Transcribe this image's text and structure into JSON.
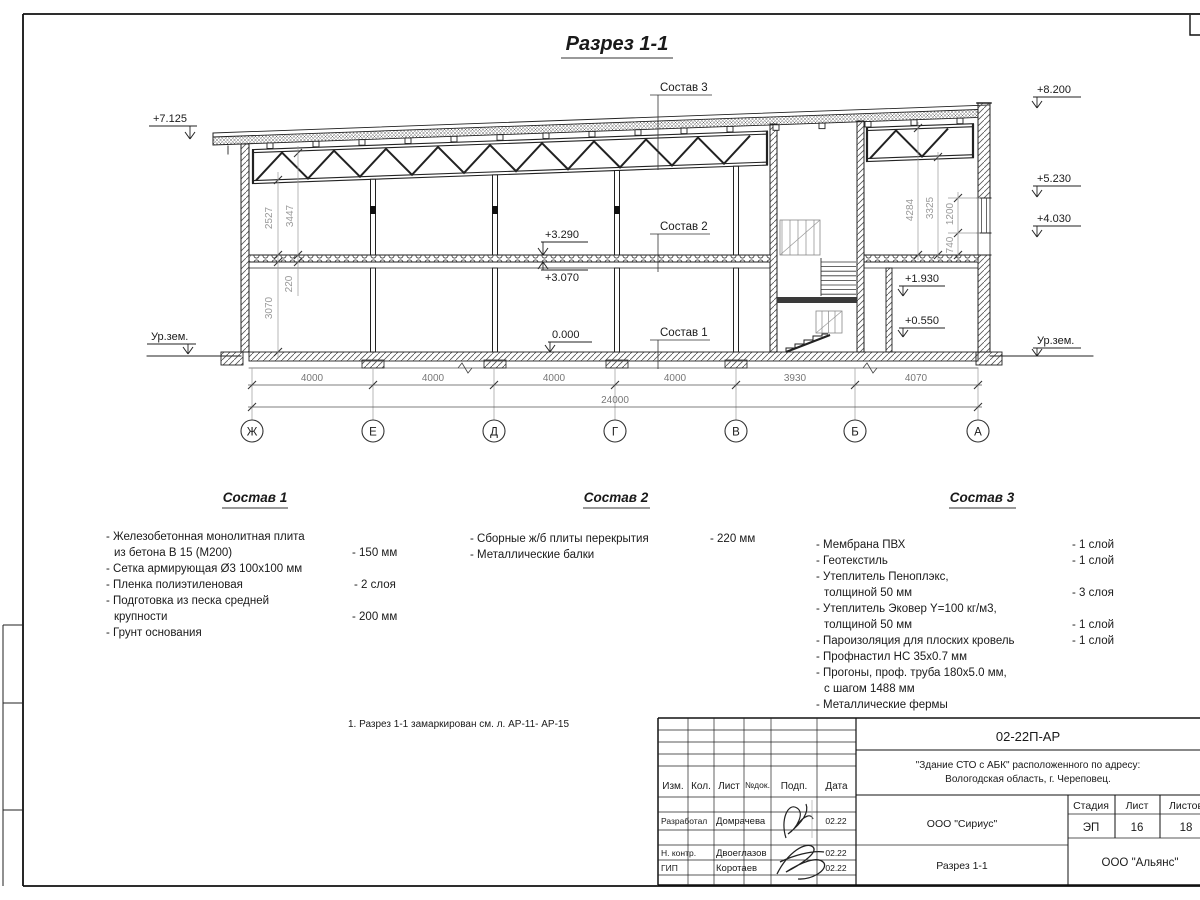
{
  "sheet": {
    "title": "Разрез 1-1",
    "note": "1. Разрез 1-1 замаркирован см. л. АР-11- АР-15"
  },
  "drawing": {
    "labels": {
      "sostav1": "Состав 1",
      "sostav2": "Состав 2",
      "sostav3": "Состав 3"
    },
    "elevations": {
      "left_top": "+7.125",
      "right_top": "+8.200",
      "right_mid1": "+5.230",
      "right_mid2": "+4.030",
      "slab_top": "+3.290",
      "slab_bottom": "+3.070",
      "floor_zero": "0.000",
      "landing": "+1.930",
      "entry": "+0.550",
      "ground_left": "Ур.зем.",
      "ground_right": "Ур.зем."
    },
    "vertical_dims": {
      "left_outer": "2527",
      "left_inner": "3447",
      "slab": "220",
      "first_floor": "3070",
      "right_outer": "4284",
      "right_inner": "3325",
      "window": "1200",
      "parapet": "740"
    },
    "horizontal_dims": [
      "4000",
      "4000",
      "4000",
      "4000",
      "3930",
      "4070"
    ],
    "total_dim": "24000",
    "axes": [
      "Ж",
      "Е",
      "Д",
      "Г",
      "В",
      "Б",
      "А"
    ]
  },
  "specs": {
    "s1": {
      "title": "Состав 1",
      "lines": [
        {
          "t": "- Железобетонная монолитная плита",
          "v": ""
        },
        {
          "t": "из бетона В 15 (М200)",
          "v": "- 150 мм"
        },
        {
          "t": "- Сетка армирующая Ø3 100х100 мм",
          "v": ""
        },
        {
          "t": "- Пленка полиэтиленовая",
          "v": "- 2 слоя"
        },
        {
          "t": "- Подготовка из песка средней",
          "v": ""
        },
        {
          "t": "крупности",
          "v": "- 200 мм"
        },
        {
          "t": "- Грунт основания",
          "v": ""
        }
      ]
    },
    "s2": {
      "title": "Состав 2",
      "lines": [
        {
          "t": "- Сборные ж/б плиты перекрытия",
          "v": "- 220 мм"
        },
        {
          "t": "- Металлические балки",
          "v": ""
        }
      ]
    },
    "s3": {
      "title": "Состав 3",
      "lines": [
        {
          "t": "- Мембрана ПВХ",
          "v": "- 1 слой"
        },
        {
          "t": "- Геотекстиль",
          "v": "- 1 слой"
        },
        {
          "t": "- Утеплитель Пеноплэкс,",
          "v": ""
        },
        {
          "t": "толщиной 50 мм",
          "v": "- 3 слоя"
        },
        {
          "t": "- Утеплитель Эковер Y=100 кг/м3,",
          "v": ""
        },
        {
          "t": "толщиной 50 мм",
          "v": "- 1 слой"
        },
        {
          "t": "- Пароизоляция для плоских кровель",
          "v": "- 1 слой"
        },
        {
          "t": "- Профнастил НС 35х0.7 мм",
          "v": ""
        },
        {
          "t": "- Прогоны, проф. труба 180х5.0 мм,",
          "v": ""
        },
        {
          "t": "с шагом 1488 мм",
          "v": ""
        },
        {
          "t": "- Металлические фермы",
          "v": ""
        }
      ]
    }
  },
  "titleblock": {
    "doc_number": "02-22П-АР",
    "project_line1": "\"Здание СТО с АБК\" расположенного по адресу:",
    "project_line2": "Вологодская область, г. Череповец.",
    "header": {
      "izm": "Изм.",
      "kol": "Кол.",
      "list": "Лист",
      "ndok": "№док.",
      "podp": "Подп.",
      "data": "Дата"
    },
    "rows": [
      {
        "role": "Разработал",
        "name": "Домрачева",
        "date": "02.22"
      },
      {
        "role": "Н. контр.",
        "name": "Двоеглазов",
        "date": "02.22"
      },
      {
        "role": "ГИП",
        "name": "Коротаев",
        "date": "02.22"
      }
    ],
    "stage_label": "Стадия",
    "sheet_label": "Лист",
    "sheets_label": "Листов",
    "stage": "ЭП",
    "sheet_no": "16",
    "sheets_total": "18",
    "org": "ООО \"Сириус\"",
    "drawing_name": "Разрез 1-1",
    "company": "ООО \"Альянс\""
  }
}
